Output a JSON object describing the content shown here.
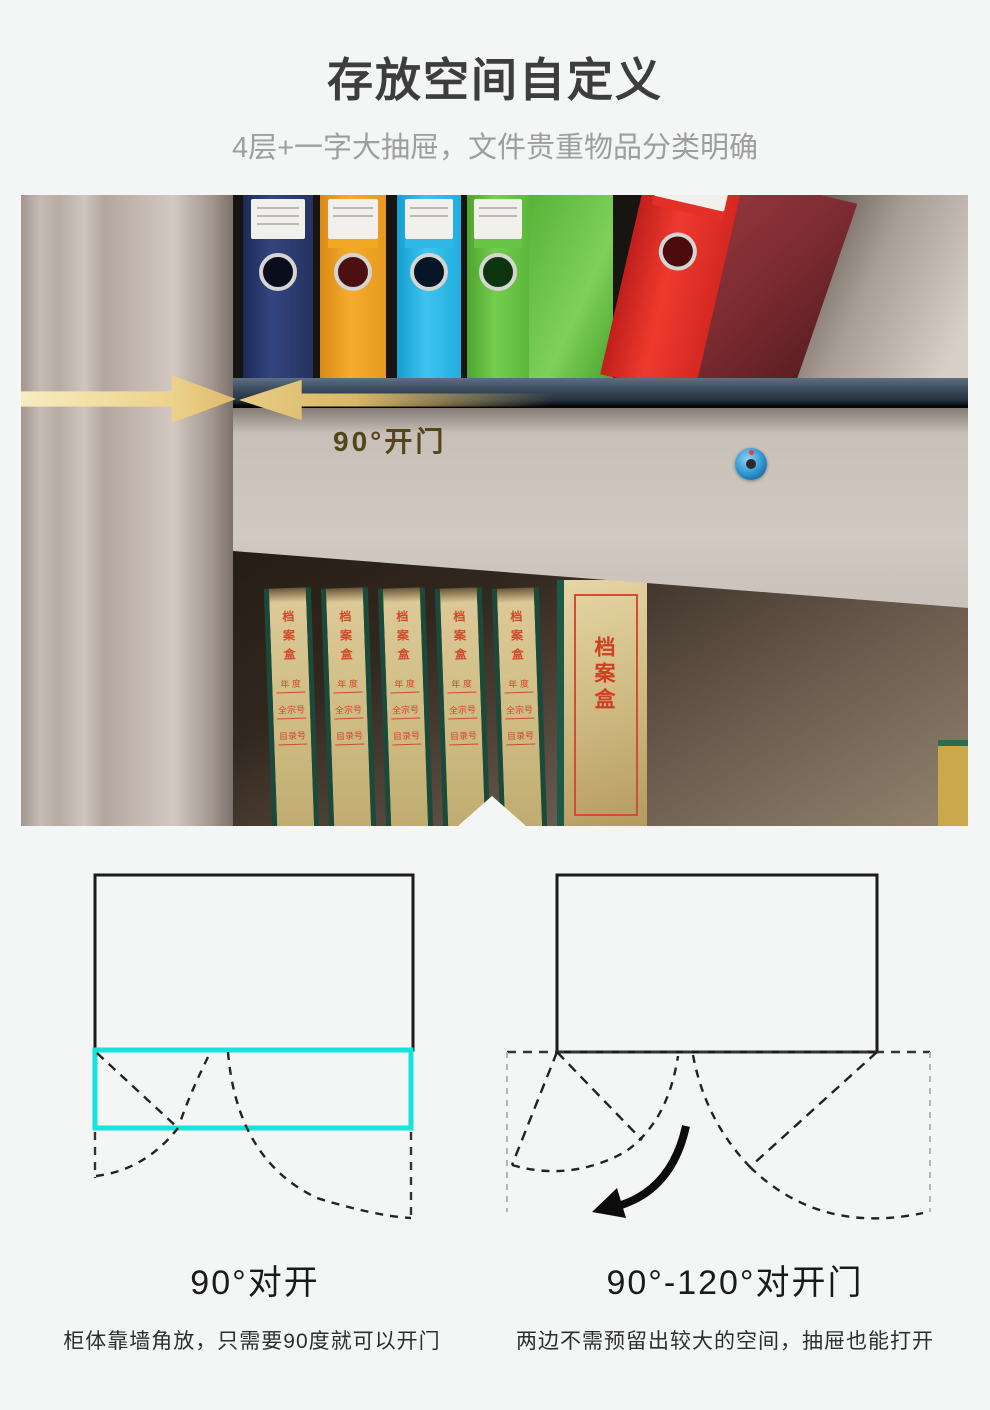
{
  "header": {
    "title": "存放空间自定义",
    "subtitle": "4层+一字大抽屉，文件贵重物品分类明确"
  },
  "photo": {
    "annotation": "90°开门",
    "archive": {
      "title": "档案盒",
      "field_year": "年 度",
      "field_file": "全宗号",
      "field_index": "目录号"
    },
    "colors": {
      "arrow_gold": "#ecd28b",
      "annotation_text": "#54461b",
      "lock_blue": "#1e8fd2",
      "shelf_slate": "#3c4d5f",
      "binder_navy": "#2e3f78",
      "binder_orange": "#f2a52c",
      "binder_cyan": "#2cb9e8",
      "binder_green": "#64c244",
      "binder_red": "#e02d26",
      "binder_maroon": "#7c2b31",
      "kraft": "#d6c493",
      "box_edge_green": "#1b4a3a",
      "archive_text_red": "#cf4a30"
    }
  },
  "diagrams": {
    "left": {
      "heading": "90°对开",
      "caption": "柜体靠墙角放，只需要90度就可以开门",
      "highlight_color": "#17e3dd"
    },
    "right": {
      "heading": "90°-120°对开门",
      "caption": "两边不需预留出较大的空间，抽屉也能打开"
    }
  },
  "page": {
    "background": "#f4f5f5"
  }
}
